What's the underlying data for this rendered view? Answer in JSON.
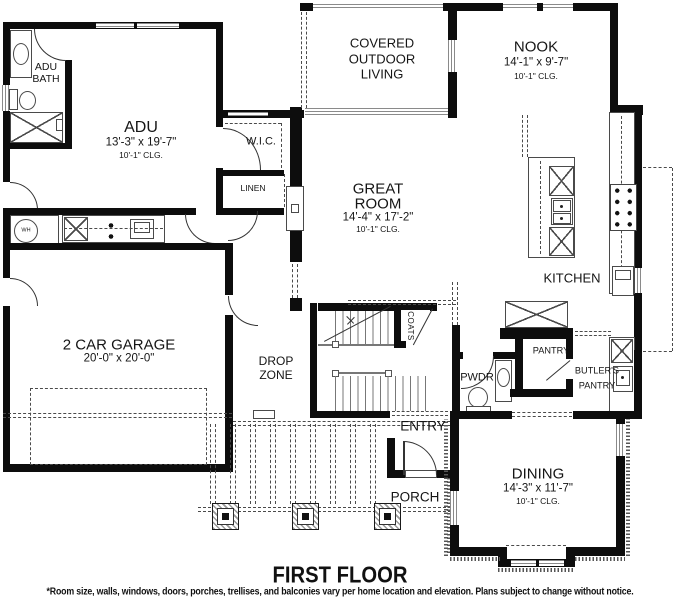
{
  "page": {
    "title": "FIRST FLOOR",
    "disclaimer": "*Room size, walls, windows, doors, porches, trellises, and balconies vary per home location and elevation. Plans subject to change without notice."
  },
  "rooms": {
    "adu_bath": {
      "name_line1": "ADU",
      "name_line2": "BATH"
    },
    "adu": {
      "name": "ADU",
      "dims": "13'-3\" x 19'-7\"",
      "ceiling": "10'-1\" CLG."
    },
    "wic": {
      "name": "W.I.C."
    },
    "linen": {
      "name": "LINEN"
    },
    "covered_outdoor_living": {
      "name_line1": "COVERED",
      "name_line2": "OUTDOOR",
      "name_line3": "LIVING"
    },
    "nook": {
      "name": "NOOK",
      "dims": "14'-1\" x 9'-7\"",
      "ceiling": "10'-1\" CLG."
    },
    "great_room": {
      "name_line1": "GREAT",
      "name_line2": "ROOM",
      "dims": "14'-4\" x 17'-2\"",
      "ceiling": "10'-1\" CLG."
    },
    "kitchen": {
      "name": "KITCHEN"
    },
    "garage": {
      "name": "2 CAR GARAGE",
      "dims": "20'-0\" x 20'-0\""
    },
    "drop_zone": {
      "name_line1": "DROP",
      "name_line2": "ZONE"
    },
    "coats": {
      "name": "COATS"
    },
    "pwdr": {
      "name": "PWDR"
    },
    "pantry": {
      "name": "PANTRY"
    },
    "butlers_pantry": {
      "name_line1": "BUTLER'S",
      "name_line2": "PANTRY"
    },
    "entry": {
      "name": "ENTRY"
    },
    "porch": {
      "name": "PORCH"
    },
    "dining": {
      "name": "DINING",
      "dims": "14'-3\" x 11'-7\"",
      "ceiling": "10'-1\" CLG."
    },
    "water_heater": {
      "label": "WH"
    }
  },
  "colors": {
    "wall": "#0d0d0d",
    "fixture_line": "#4a4a4a",
    "text": "#151515",
    "background": "#ffffff"
  }
}
